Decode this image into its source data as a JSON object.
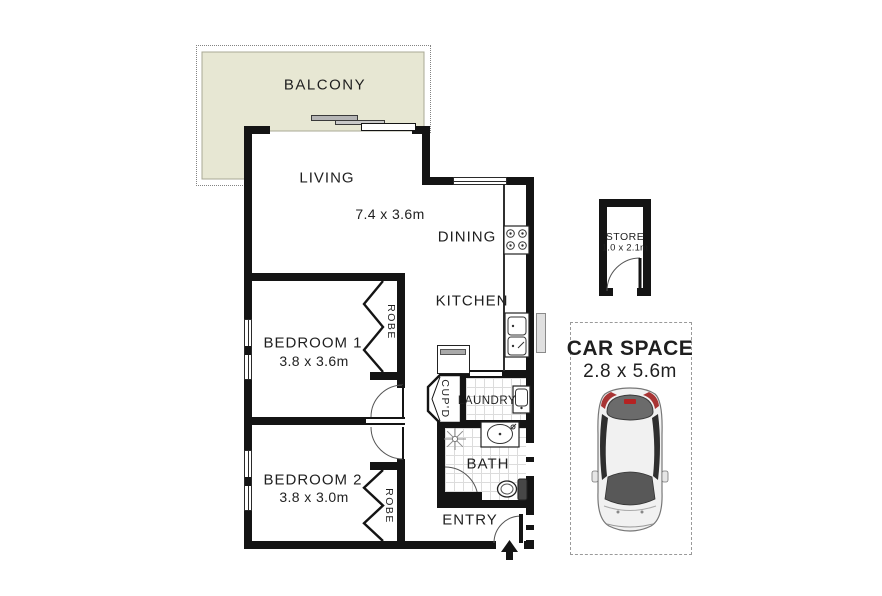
{
  "title": "Apartment floor plan",
  "rooms": {
    "balcony": {
      "label": "BALCONY"
    },
    "living": {
      "label": "LIVING",
      "dims": "7.4 x 3.6m"
    },
    "dining": {
      "label": "DINING"
    },
    "kitchen": {
      "label": "KITCHEN"
    },
    "bedroom1": {
      "label": "BEDROOM 1",
      "dims": "3.8 x 3.6m"
    },
    "bedroom2": {
      "label": "BEDROOM 2",
      "dims": "3.8 x 3.0m"
    },
    "robe": {
      "label": "ROBE"
    },
    "cupboard": {
      "label": "CUP'D"
    },
    "laundry": {
      "label": "LAUNDRY"
    },
    "bath": {
      "label": "BATH"
    },
    "entry": {
      "label": "ENTRY"
    },
    "store": {
      "label": "STORE",
      "dims": "1.0 x 2.1m"
    },
    "car_space": {
      "label": "CAR SPACE",
      "dims": "2.8 x 5.6m"
    }
  },
  "icons": {
    "cooktop-icon": "4-burner cooktop circles",
    "sink-icon": "double bowl kitchen sink",
    "laundry-tub-icon": "laundry tub",
    "vanity-basin-icon": "oval vanity basin with tap",
    "toilet-icon": "toilet with cistern",
    "ceiling-light-icon": "starburst light symbol",
    "entry-arrow-icon": "black arrow marking entry",
    "car-icon": "top view car in car space",
    "door-arc-icon": "quarter-circle door swing",
    "bifold-robe-icon": "zigzag bifold robe doors",
    "sliding-door-icon": "overlapping sliding panels"
  },
  "colors": {
    "wall": "#141414",
    "balcony_fill": "#e7e7d3",
    "tile_line": "#dcdcdc",
    "text": "#1f1f1f",
    "car_red": "#a83434",
    "dashed_border": "#9a9a9a",
    "window_gray": "#e0e0e0"
  }
}
